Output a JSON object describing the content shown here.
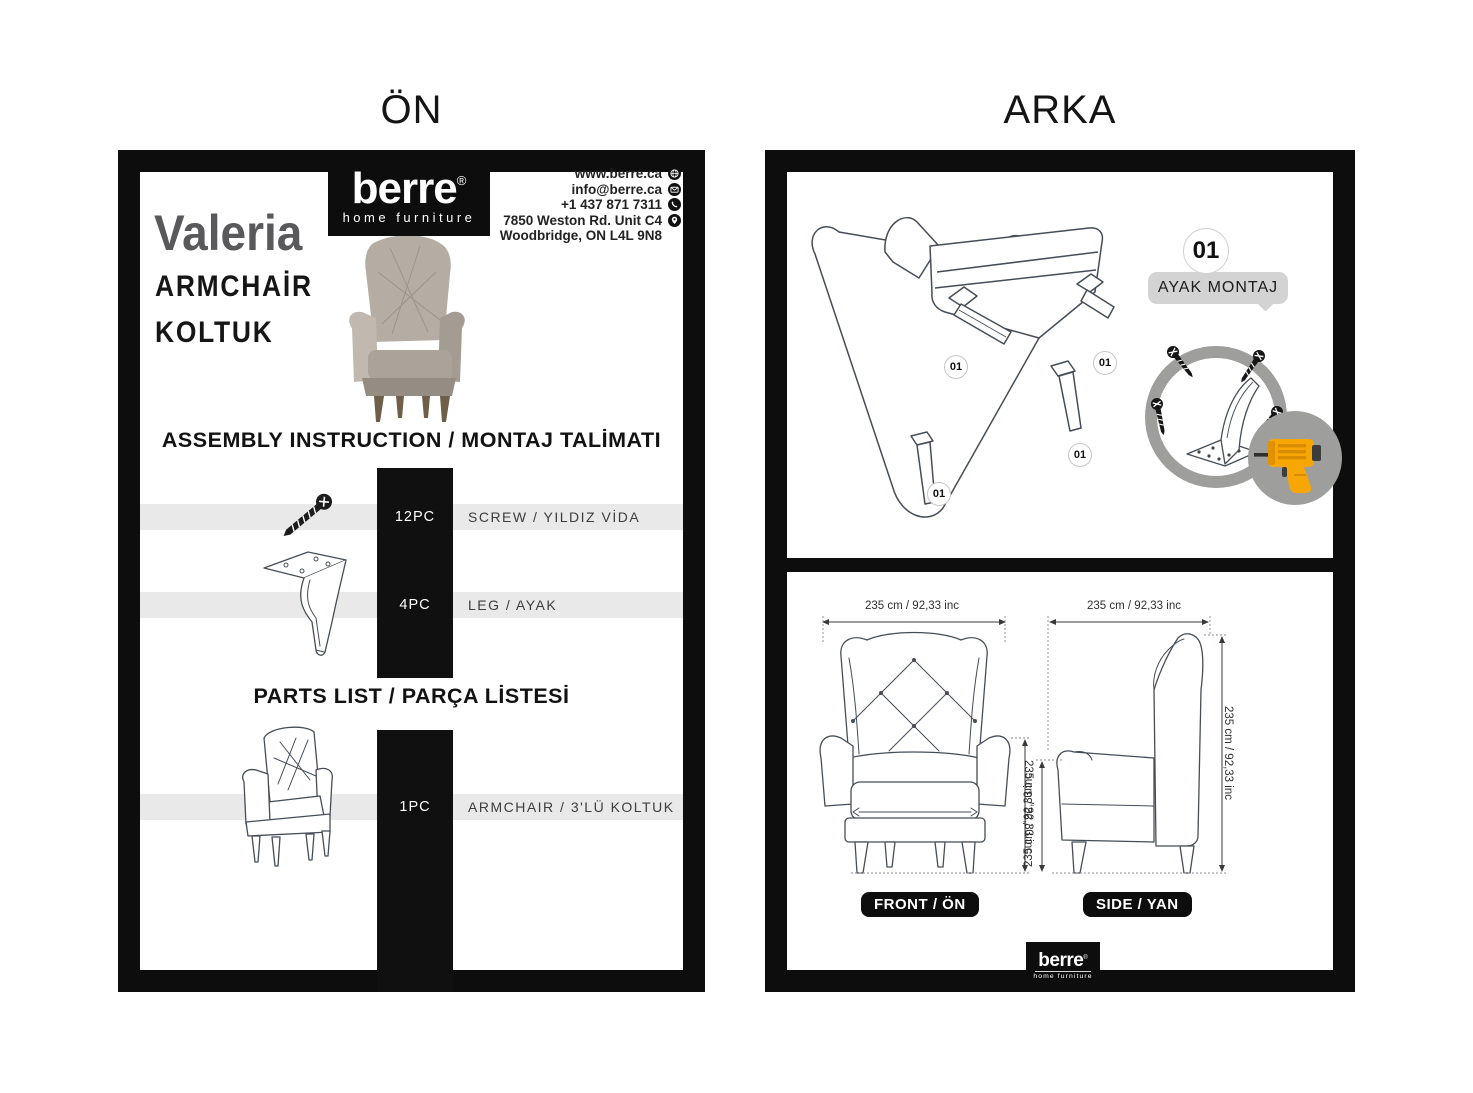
{
  "page_titles": {
    "left": "ÖN",
    "right": "ARKA"
  },
  "brand": {
    "name": "berre",
    "reg": "®",
    "tagline": "home furniture"
  },
  "contact": {
    "lines": [
      {
        "text": "www.berre.ca",
        "icon": "globe"
      },
      {
        "text": "info@berre.ca",
        "icon": "email"
      },
      {
        "text": "+1 437 871 7311",
        "icon": "phone"
      },
      {
        "text": "7850 Weston Rd. Unit C4",
        "icon": "location"
      },
      {
        "text": "Woodbridge, ON L4L 9N8",
        "icon": ""
      }
    ]
  },
  "product": {
    "name": "Valeria",
    "category_en": "ARMCHAİR",
    "category_tr": "KOLTUK"
  },
  "front_page": {
    "assembly_heading": "ASSEMBLY INSTRUCTION / MONTAJ TALİMATI",
    "parts_heading": "PARTS LIST / PARÇA LİSTESİ",
    "assembly_rows": [
      {
        "qty": "12PC",
        "label": "SCREW / YILDIZ VİDA",
        "icon": "screw"
      },
      {
        "qty": "4PC",
        "label": "LEG / AYAK",
        "icon": "leg"
      }
    ],
    "parts_rows": [
      {
        "qty": "1PC",
        "label": "ARMCHAIR / 3'LÜ KOLTUK",
        "icon": "armchair"
      }
    ]
  },
  "back_page": {
    "step_number": "01",
    "step_label": "AYAK MONTAJ",
    "leg_markers": [
      "01",
      "01",
      "01",
      "01"
    ],
    "front_view": {
      "label": "FRONT / ÖN",
      "dim_top": "235 cm / 92,33 inc",
      "dim_right": "235 cm / 92,33 inc"
    },
    "side_view": {
      "label": "SIDE / YAN",
      "dim_top": "235 cm / 92,33 inc",
      "dim_left": "235 cm / 92,33 inc",
      "dim_right": "235 cm / 92,33 inc"
    }
  },
  "colors": {
    "frame_black": "#0d0d0d",
    "strip_gray": "#e9e9e9",
    "badge_gray": "#d3d3d3",
    "ring_gray": "#9e9e9d",
    "drill_orange": "#f7a604",
    "product_title_gray": "#59595c"
  }
}
